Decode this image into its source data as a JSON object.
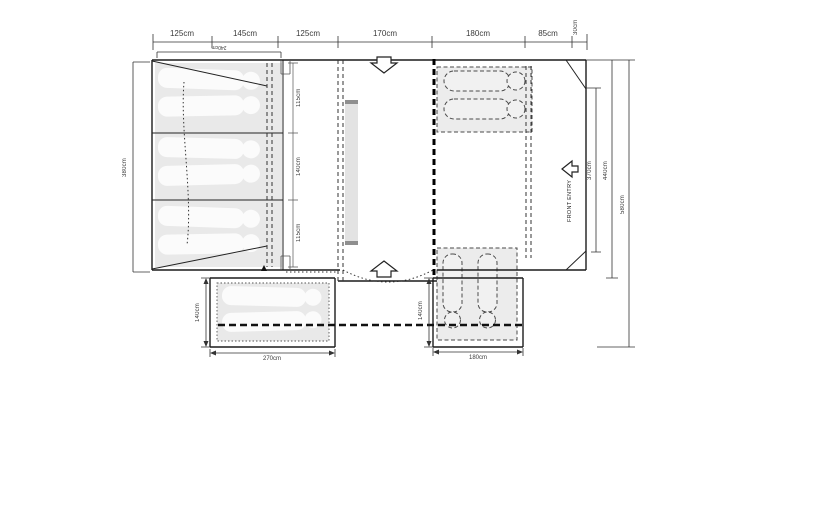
{
  "ruler": {
    "segments": [
      {
        "label": "125cm"
      },
      {
        "label": "145cm"
      },
      {
        "label": "125cm"
      },
      {
        "label": "170cm"
      },
      {
        "label": "180cm"
      },
      {
        "label": "85cm"
      }
    ],
    "end_label": "30cm"
  },
  "dims": {
    "bedroom_width": "240cm",
    "left_height": "380cm",
    "compartments": [
      {
        "label": "115cm"
      },
      {
        "label": "140cm"
      },
      {
        "label": "115cm"
      }
    ],
    "right_inner": "370cm",
    "right_mid": "440cm",
    "right_outer": "580cm",
    "left_annex_depth": "140cm",
    "left_annex_width": "270cm",
    "right_annex_depth": "140cm",
    "right_annex_width": "180cm"
  },
  "labels": {
    "front_entry": "FRONT ENTRY"
  }
}
